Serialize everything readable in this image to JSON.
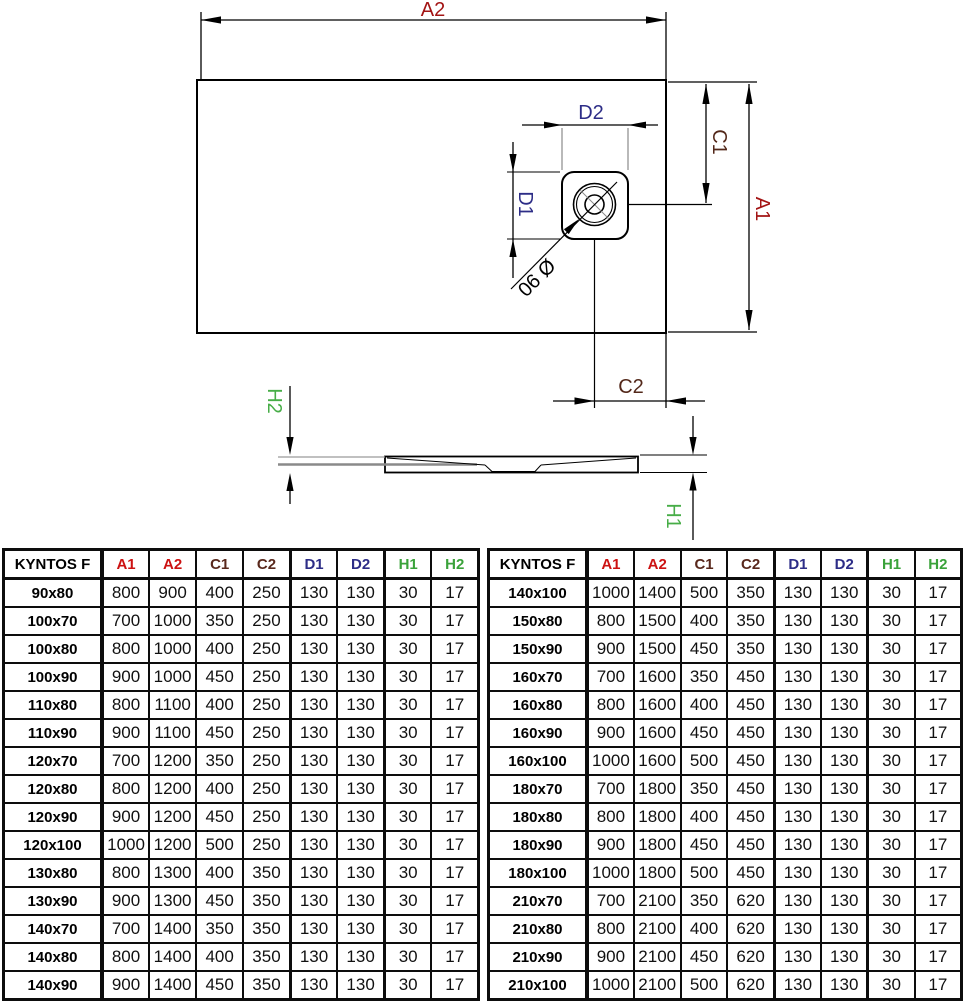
{
  "drawing": {
    "labels": {
      "a2": "A2",
      "a1": "A1",
      "c1": "C1",
      "c2": "C2",
      "d1": "D1",
      "d2": "D2",
      "h1": "H1",
      "h2": "H2",
      "drain_diameter": "Ø 90"
    },
    "colors": {
      "dim_red": "#a31414",
      "dim_maroon": "#53281a",
      "dim_blue": "#2d2d87",
      "dim_green": "#47ad47",
      "line": "#000000"
    }
  },
  "tables": {
    "header": [
      "KYNTOS F",
      "A1",
      "A2",
      "C1",
      "C2",
      "D1",
      "D2",
      "H1",
      "H2"
    ],
    "header_colors": [
      "#000000",
      "#cc1212",
      "#cc1212",
      "#59281c",
      "#59281c",
      "#2d2d87",
      "#2d2d87",
      "#3aa23a",
      "#3aa23a"
    ],
    "left_rows": [
      [
        "90x80",
        "800",
        "900",
        "400",
        "250",
        "130",
        "130",
        "30",
        "17"
      ],
      [
        "100x70",
        "700",
        "1000",
        "350",
        "250",
        "130",
        "130",
        "30",
        "17"
      ],
      [
        "100x80",
        "800",
        "1000",
        "400",
        "250",
        "130",
        "130",
        "30",
        "17"
      ],
      [
        "100x90",
        "900",
        "1000",
        "450",
        "250",
        "130",
        "130",
        "30",
        "17"
      ],
      [
        "110x80",
        "800",
        "1100",
        "400",
        "250",
        "130",
        "130",
        "30",
        "17"
      ],
      [
        "110x90",
        "900",
        "1100",
        "450",
        "250",
        "130",
        "130",
        "30",
        "17"
      ],
      [
        "120x70",
        "700",
        "1200",
        "350",
        "250",
        "130",
        "130",
        "30",
        "17"
      ],
      [
        "120x80",
        "800",
        "1200",
        "400",
        "250",
        "130",
        "130",
        "30",
        "17"
      ],
      [
        "120x90",
        "900",
        "1200",
        "450",
        "250",
        "130",
        "130",
        "30",
        "17"
      ],
      [
        "120x100",
        "1000",
        "1200",
        "500",
        "250",
        "130",
        "130",
        "30",
        "17"
      ],
      [
        "130x80",
        "800",
        "1300",
        "400",
        "350",
        "130",
        "130",
        "30",
        "17"
      ],
      [
        "130x90",
        "900",
        "1300",
        "450",
        "350",
        "130",
        "130",
        "30",
        "17"
      ],
      [
        "140x70",
        "700",
        "1400",
        "350",
        "350",
        "130",
        "130",
        "30",
        "17"
      ],
      [
        "140x80",
        "800",
        "1400",
        "400",
        "350",
        "130",
        "130",
        "30",
        "17"
      ],
      [
        "140x90",
        "900",
        "1400",
        "450",
        "350",
        "130",
        "130",
        "30",
        "17"
      ]
    ],
    "right_rows": [
      [
        "140x100",
        "1000",
        "1400",
        "500",
        "350",
        "130",
        "130",
        "30",
        "17"
      ],
      [
        "150x80",
        "800",
        "1500",
        "400",
        "350",
        "130",
        "130",
        "30",
        "17"
      ],
      [
        "150x90",
        "900",
        "1500",
        "450",
        "350",
        "130",
        "130",
        "30",
        "17"
      ],
      [
        "160x70",
        "700",
        "1600",
        "350",
        "450",
        "130",
        "130",
        "30",
        "17"
      ],
      [
        "160x80",
        "800",
        "1600",
        "400",
        "450",
        "130",
        "130",
        "30",
        "17"
      ],
      [
        "160x90",
        "900",
        "1600",
        "450",
        "450",
        "130",
        "130",
        "30",
        "17"
      ],
      [
        "160x100",
        "1000",
        "1600",
        "500",
        "450",
        "130",
        "130",
        "30",
        "17"
      ],
      [
        "180x70",
        "700",
        "1800",
        "350",
        "450",
        "130",
        "130",
        "30",
        "17"
      ],
      [
        "180x80",
        "800",
        "1800",
        "400",
        "450",
        "130",
        "130",
        "30",
        "17"
      ],
      [
        "180x90",
        "900",
        "1800",
        "450",
        "450",
        "130",
        "130",
        "30",
        "17"
      ],
      [
        "180x100",
        "1000",
        "1800",
        "500",
        "450",
        "130",
        "130",
        "30",
        "17"
      ],
      [
        "210x70",
        "700",
        "2100",
        "350",
        "620",
        "130",
        "130",
        "30",
        "17"
      ],
      [
        "210x80",
        "800",
        "2100",
        "400",
        "620",
        "130",
        "130",
        "30",
        "17"
      ],
      [
        "210x90",
        "900",
        "2100",
        "450",
        "620",
        "130",
        "130",
        "30",
        "17"
      ],
      [
        "210x100",
        "1000",
        "2100",
        "500",
        "620",
        "130",
        "130",
        "30",
        "17"
      ]
    ]
  }
}
